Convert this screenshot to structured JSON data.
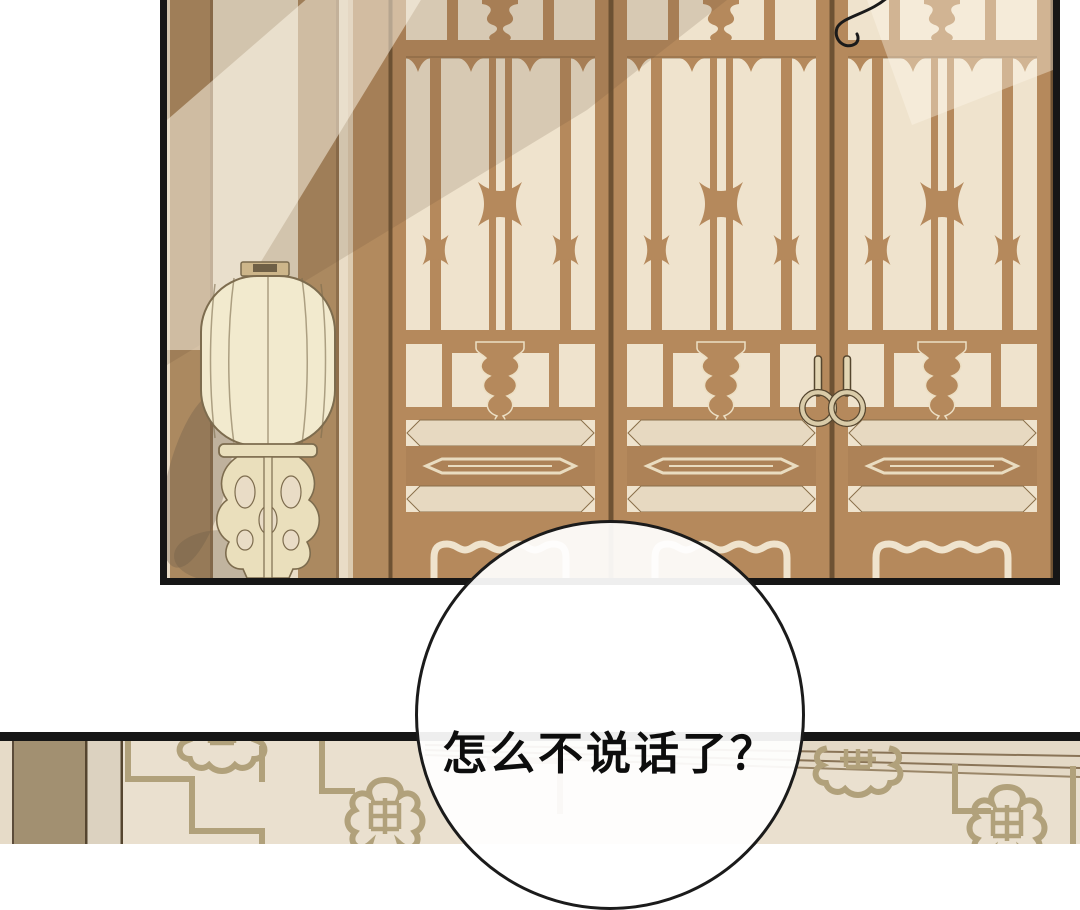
{
  "page": {
    "type": "comic-page",
    "background": "#ffffff"
  },
  "speech_bubble": {
    "text": "怎么不说话了？"
  },
  "scene": {
    "top_panel": "traditional lattice doors with wall lantern",
    "bottom_panel": "wall with fretwork pattern"
  },
  "colors": {
    "ink": "#161616",
    "wood": "#b5895c",
    "wood-dark": "#6e5233",
    "wood-deep": "#ad8257",
    "paper": "#efe3cd",
    "paper-shade": "#e7d9c1",
    "wall": "#e9dcc6",
    "pillar": "#ab8960",
    "lantern": "#f2eace",
    "lantern-line": "#7d6c4e",
    "stand": "#eadfbc",
    "bottom-wall": "#eae0cf",
    "bottom-pillar": "#a29071",
    "bottom-strip": "#dcd2c0",
    "fret": "#b1a17b",
    "trim-line": "#8a7457",
    "handle": "#d9cba8",
    "bubble-fill": "rgba(255,255,255,0.93)"
  }
}
